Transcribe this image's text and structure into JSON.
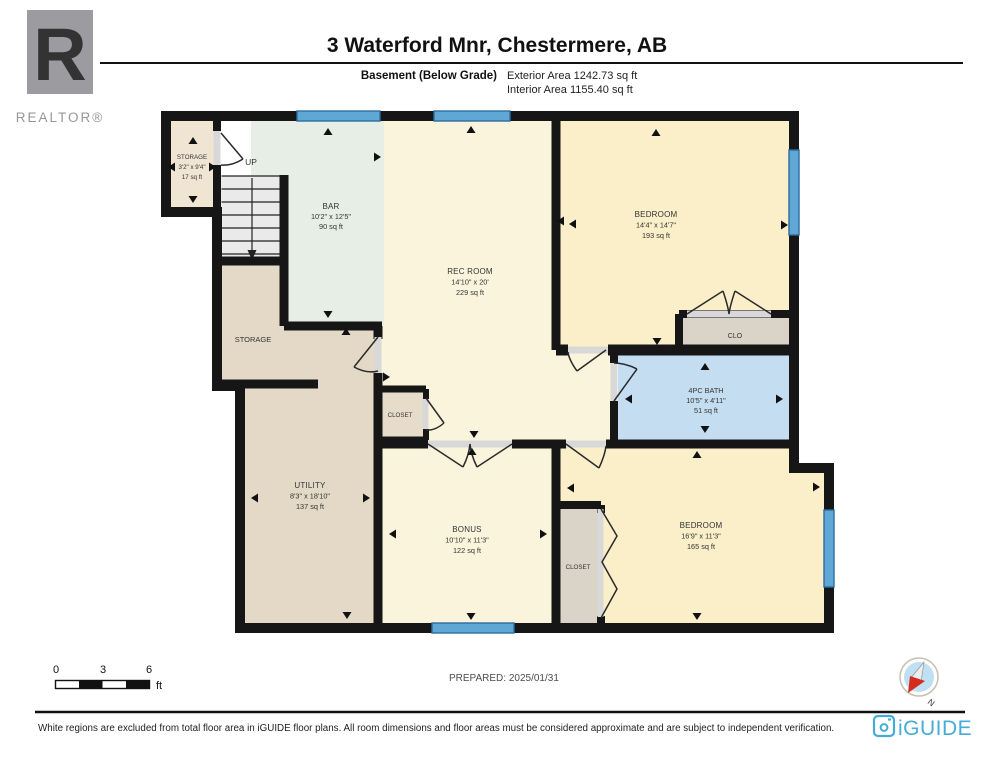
{
  "colors": {
    "wall": "#161616",
    "room_cream": "#FBF4DC",
    "room_bedroom": "#FAEFC9",
    "room_bar_mint": "#E7EEE6",
    "room_tan": "#E3D9C6",
    "room_small_storage": "#F0E5D3",
    "room_closet_gray": "#DAD3C7",
    "room_bath_blue": "#C5DDF1",
    "window_blue": "#5FA8D6",
    "window_border": "#2E6C9E",
    "stairs_gray": "#EAEAEA",
    "sill_gray": "#D8D8D8",
    "brand_teal": "#45ACD8",
    "realtor_gray": "#9B9BA0",
    "compass_red": "#D42B1E"
  },
  "header": {
    "realtor": {
      "letter": "R",
      "label": "REALTOR®"
    },
    "title": "3 Waterford Mnr, Chestermere, AB",
    "floor_label": "Basement (Below Grade)",
    "exterior_area": "Exterior Area 1242.73 sq ft",
    "interior_area": "Interior Area 1155.40 sq ft"
  },
  "plan": {
    "rooms": [
      {
        "name": "STORAGE",
        "dims": "3'2\" x 9'4\"",
        "area": "17 sq ft"
      },
      {
        "name": "BAR",
        "dims": "10'2\" x 12'5\"",
        "area": "90 sq ft"
      },
      {
        "name": "REC ROOM",
        "dims": "14'10\" x 20'",
        "area": "229 sq ft"
      },
      {
        "name": "BEDROOM",
        "dims": "14'4\" x 14'7\"",
        "area": "193 sq ft"
      },
      {
        "name": "4PC BATH",
        "dims": "10'5\" x 4'11\"",
        "area": "51 sq ft"
      },
      {
        "name": "BEDROOM",
        "dims": "16'9\" x 11'3\"",
        "area": "165 sq ft"
      },
      {
        "name": "BONUS",
        "dims": "10'10\" x 11'3\"",
        "area": "122 sq ft"
      },
      {
        "name": "UTILITY",
        "dims": "8'3\" x 18'10\"",
        "area": "137 sq ft"
      }
    ],
    "labels": {
      "up": "UP",
      "storage_big": "STORAGE",
      "clo": "CLO",
      "closet_small": "CLOSET",
      "closet_bedroom": "CLOSET"
    },
    "icons": {
      "dimension_arrow": "small black triangle ▲▼◄►",
      "stairs_arrow": "down arrow",
      "window": "blue band in wall",
      "compass_needle": "red/white needle"
    }
  },
  "footer": {
    "scale": {
      "ticks": [
        "0",
        "3",
        "6"
      ],
      "unit": "ft"
    },
    "prepared": "PREPARED: 2025/01/31",
    "compass_label": "N",
    "disclaimer": "White regions are excluded from total floor area in iGUIDE floor plans. All room dimensions and floor areas must be considered approximate and are subject to independent verification.",
    "brand": "iGUIDE"
  }
}
